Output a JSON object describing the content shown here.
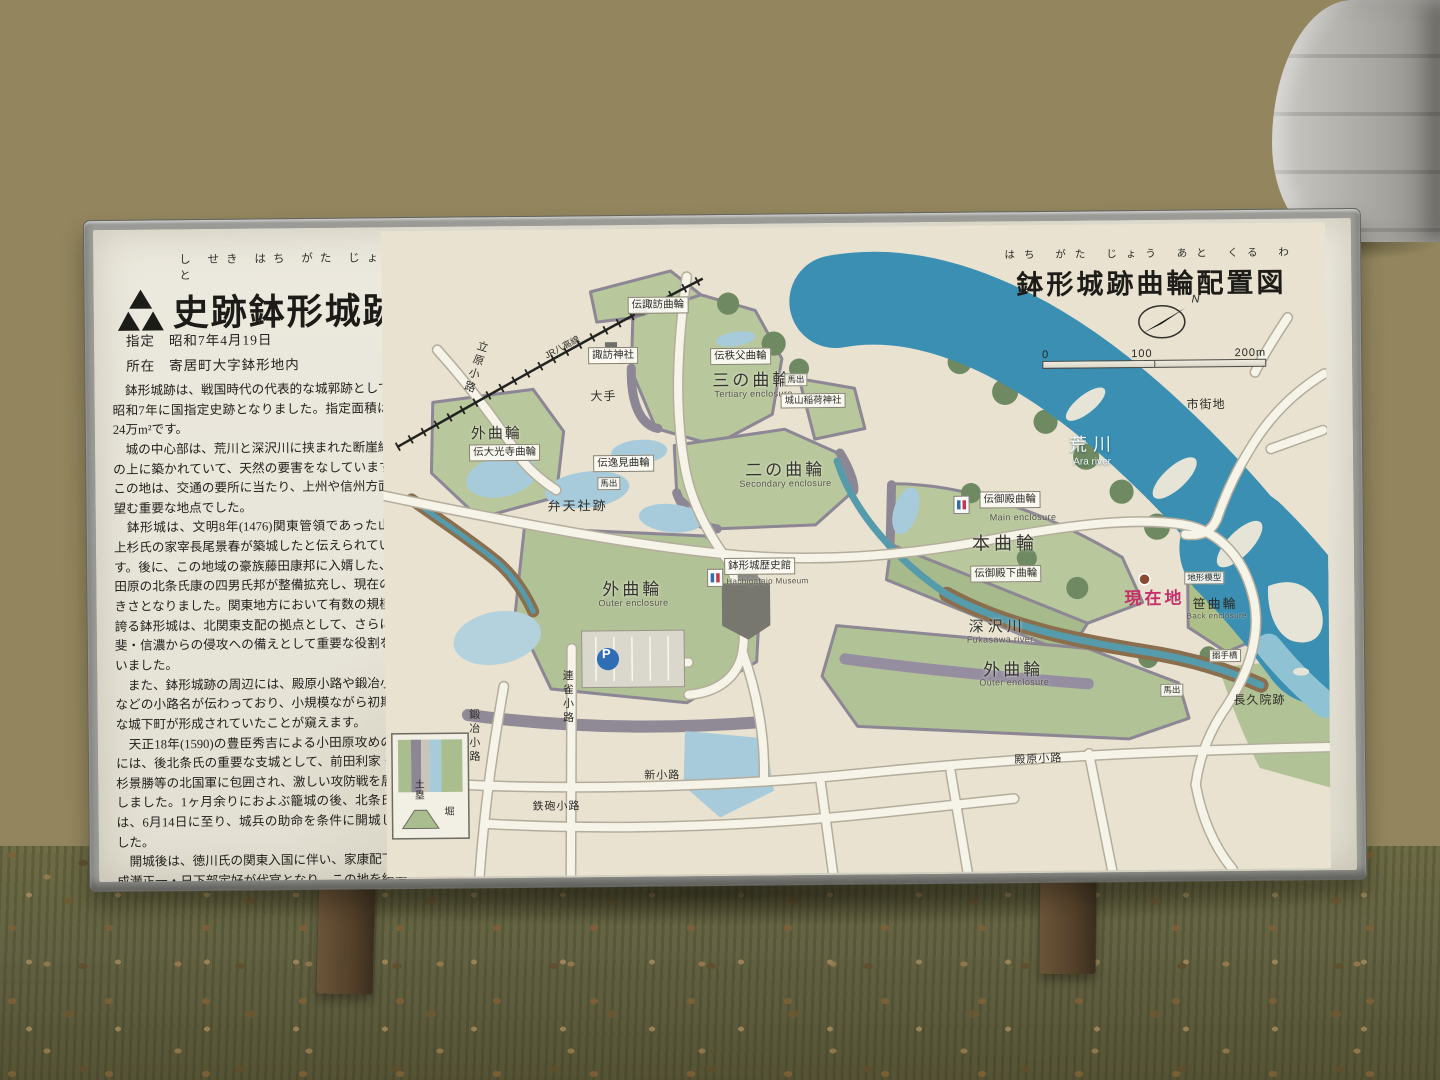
{
  "sign": {
    "header": {
      "furigana": "し せき はち がた じょう あと",
      "title": "史跡鉢形城跡",
      "designation_label": "指定",
      "designation_value": "昭和7年4月19日",
      "location_label": "所在",
      "location_value": "寄居町大字鉢形地内"
    },
    "paragraphs": [
      "　鉢形城跡は、戦国時代の代表的な城郭跡として、昭和7年に国指定史跡となりました。指定面積は約24万m²です。",
      "　城の中心部は、荒川と深沢川に挟まれた断崖絶壁の上に築かれていて、天然の要害をなしています。この地は、交通の要所に当たり、上州や信州方面を望む重要な地点でした。",
      "　鉢形城は、文明8年(1476)関東管領であった山内上杉氏の家宰長尾景春が築城したと伝えられています。後に、この地域の豪族藤田康邦に入婿した、小田原の北条氏康の四男氏邦が整備拡充し、現在の大きさとなりました。関東地方において有数の規模を誇る鉢形城は、北関東支配の拠点として、さらに甲斐・信濃からの侵攻への備えとして重要な役割を担いました。",
      "　また、鉢形城跡の周辺には、殿原小路や鍛冶小路などの小路名が伝わっており、小規模ながら初期的な城下町が形成されていたことが窺えます。",
      "　天正18年(1590)の豊臣秀吉による小田原攻めの際には、後北条氏の重要な支城として、前田利家・上杉景勝等の北国軍に包囲され、激しい攻防戦を展開しました。1ヶ月余りにおよぶ籠城の後、北条氏邦は、6月14日に至り、城兵の助命を条件に開城しました。",
      "　開城後は、徳川氏の関東入国に伴い、家康配下の成瀬正一・日下部定好が代官となり、この地を統治しました。"
    ],
    "map": {
      "furigana": "はち がた じょう あと くる わ",
      "title": "鉢形城跡曲輪配置図",
      "north": "N",
      "scale": {
        "zero": "0",
        "hundred": "100",
        "twohundred": "200m"
      },
      "legend": {
        "earthwork": "土塁",
        "moat": "堀"
      },
      "parking": "P",
      "labels": {
        "den_suwa": "伝諏訪曲輪",
        "suwa_jinja": "諏訪神社",
        "den_chichibu": "伝秩父曲輪",
        "sannokuruwa": "三の曲輪",
        "tertiary_en": "Tertiary enclosure",
        "shiroyama_inari": "城山稲荷神社",
        "ote": "大手",
        "sotokuruwa": "外曲輪",
        "outer_en": "Outer enclosure",
        "den_daikoji": "伝大光寺曲輪",
        "den_itsumi": "伝逸見曲輪",
        "bentensha": "弁天社跡",
        "umadashi": "馬出",
        "ninokuruwa": "二の曲輪",
        "secondary_en": "Secondary enclosure",
        "den_goten": "伝御殿曲輪",
        "main_en": "Main enclosure",
        "honkuruwa": "本曲輪",
        "den_gotenshita": "伝御殿下曲輪",
        "genzaichi": "現在地",
        "chikei_mokei": "地形模型",
        "sasakuruwa": "笹曲輪",
        "back_en": "Back enclosure",
        "arakawa": "荒川",
        "ara_river_en": "Ara river",
        "shigaichi": "市街地",
        "fukasawa": "深沢川",
        "fukasawa_en": "Fukasawa river",
        "rekishikan": "鉢形城歴史館",
        "museum_en": "Hachigatajo Museum",
        "renjaku": "連雀小路",
        "kaji": "鍛冶小路",
        "shin": "新小路",
        "teppo": "鉄砲小路",
        "tachihara": "立原小路",
        "tonohara": "殿原小路",
        "chokyuin": "長久院跡",
        "jr_line": "JR八高線",
        "karamete": "搦手橋"
      }
    }
  }
}
